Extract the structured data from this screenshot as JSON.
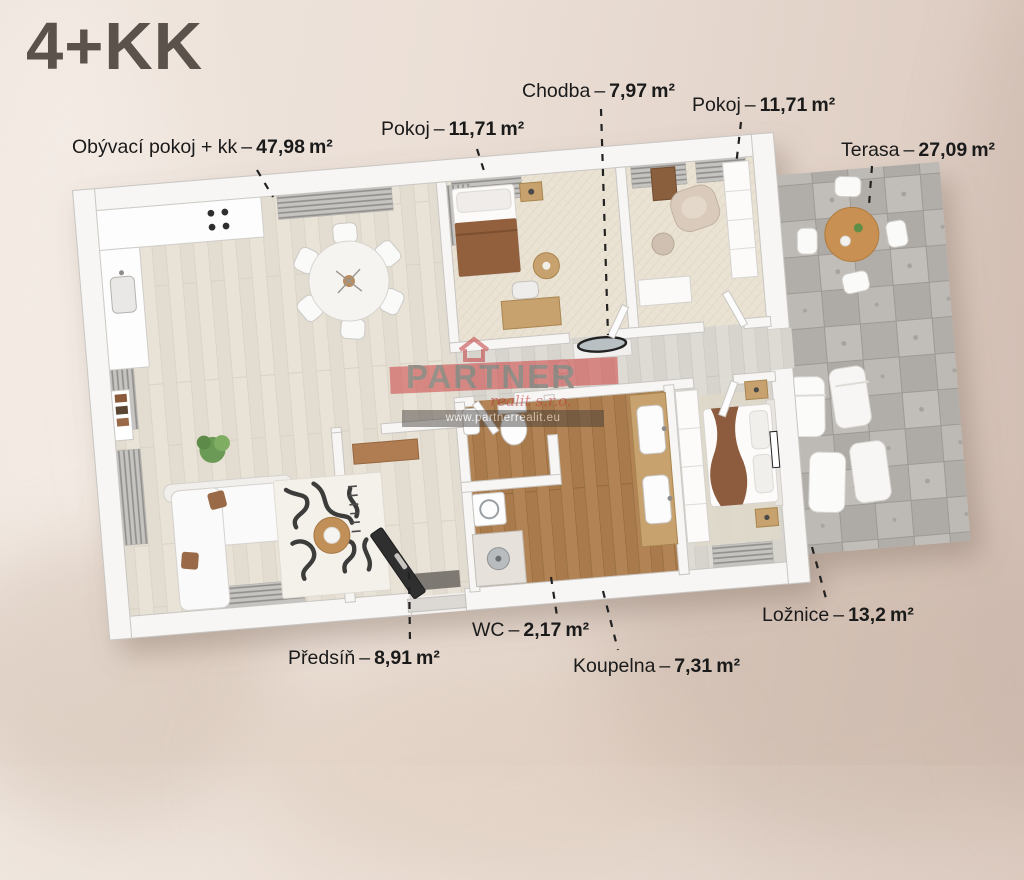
{
  "title": "4+KK",
  "unit": "m²",
  "sep": "–",
  "watermark": {
    "brand": "PARTNER",
    "sub": "realit s.r.o.",
    "url": "www.partnerrealit.eu"
  },
  "labels": [
    {
      "id": "obyvaci",
      "name": "Obývací pokoj + kk",
      "value": "47,98"
    },
    {
      "id": "pokoj-top",
      "name": "Pokoj",
      "value": "11,71"
    },
    {
      "id": "chodba",
      "name": "Chodba",
      "value": "7,97"
    },
    {
      "id": "pokoj-right",
      "name": "Pokoj",
      "value": "11,71"
    },
    {
      "id": "terasa",
      "name": "Terasa",
      "value": "27,09"
    },
    {
      "id": "loznice",
      "name": "Ložnice",
      "value": "13,2"
    },
    {
      "id": "wc",
      "name": "WC",
      "value": "2,17"
    },
    {
      "id": "koupelna",
      "name": "Koupelna",
      "value": "7,31"
    },
    {
      "id": "predsin",
      "name": "Předsíň",
      "value": "8,91"
    }
  ],
  "colors": {
    "background": "#e8dcd3",
    "title_text": "#5b534b",
    "label_text": "#1a1a1a",
    "wall": "#f7f6f4",
    "floor_wood_light": "#e7e0d4",
    "floor_wood_brown": "#b28355",
    "floor_carpet": "#eae3d4",
    "terrace_stone": "#b6b2ad",
    "accent_red": "#cf4343"
  }
}
